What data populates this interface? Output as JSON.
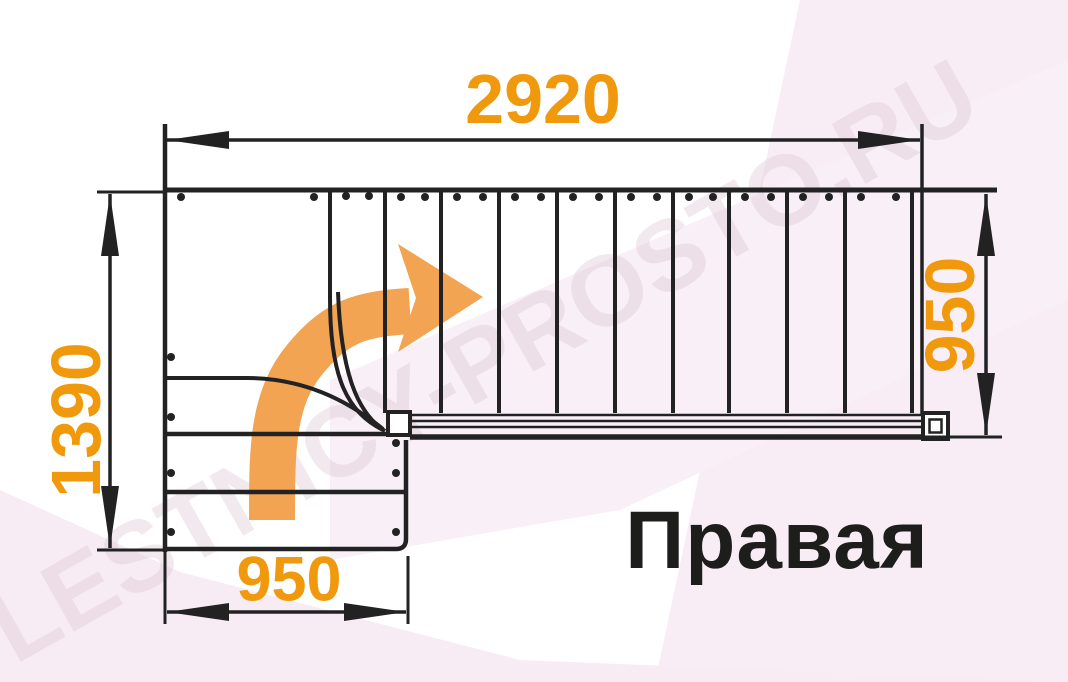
{
  "title": {
    "label": "Правая"
  },
  "dimensions": {
    "top": "2920",
    "left": "1390",
    "right": "950",
    "bottom": "950",
    "unit_note": "mm"
  },
  "watermark": {
    "text": "LESTNICY-PROSTO.RU"
  },
  "icons": {
    "direction_arrow": "turn-right-arrow"
  },
  "colors": {
    "dimension_text": "#f0990d",
    "arrow_fill": "#f2a452",
    "line": "#222222",
    "title_text": "#1d1d1b",
    "background_tint": "#f8edf5",
    "watermark_text": "#e6d4e0"
  }
}
